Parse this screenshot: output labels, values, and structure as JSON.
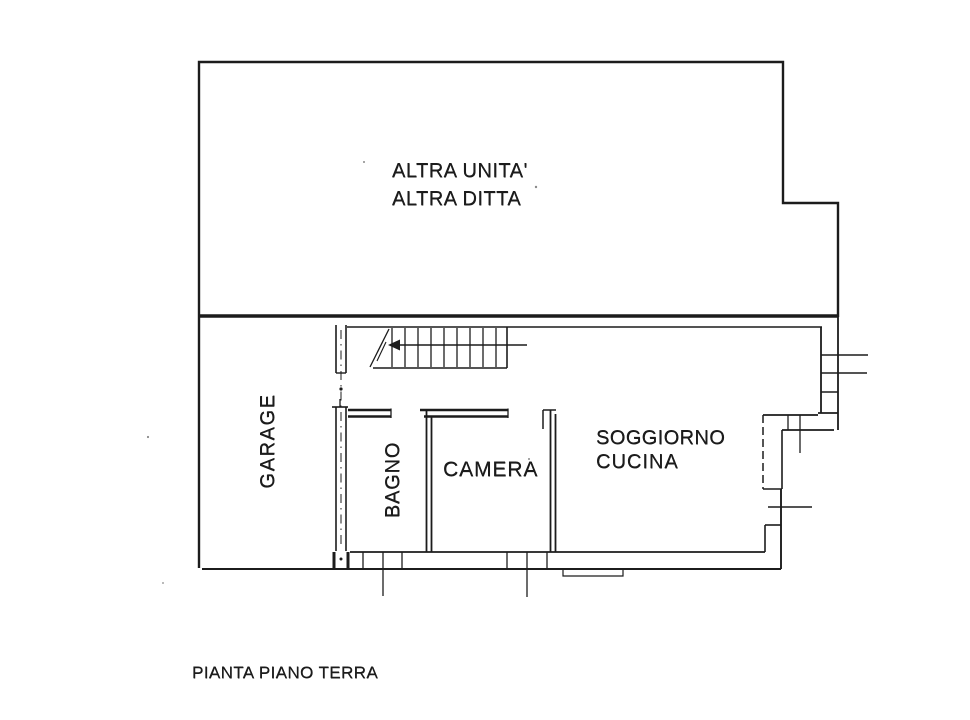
{
  "plan": {
    "caption": "PIANTA PIANO TERRA",
    "rooms": {
      "altra_unita": {
        "line1": "ALTRA UNITA'",
        "line2": "ALTRA DITTA"
      },
      "garage": "GARAGE",
      "bagno": "BAGNO",
      "camera": "CAMERA",
      "soggiorno": {
        "line1": "SOGGIORNO",
        "line2": "CUCINA"
      }
    },
    "colors": {
      "ink": "#1c1c1c",
      "paper": "#ffffff"
    }
  }
}
